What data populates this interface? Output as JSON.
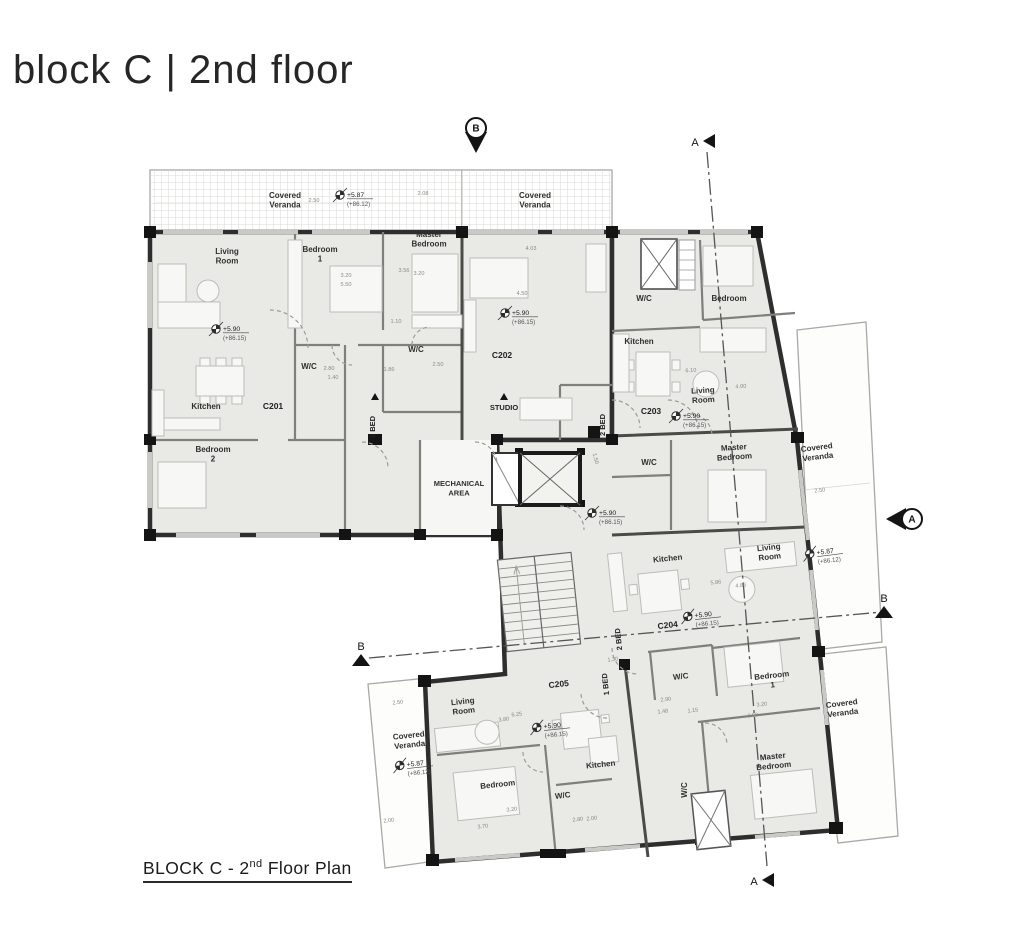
{
  "title": "block C | 2nd floor",
  "caption": {
    "prefix": "BLOCK C - 2",
    "sup": "nd",
    "suffix": " Floor Plan"
  },
  "sections": {
    "a": "A",
    "b": "B"
  },
  "labels": {
    "veranda": "Covered Veranda",
    "mechanical": "MECHANICAL AREA",
    "units": [
      "C201",
      "C202",
      "C203",
      "C204",
      "C205"
    ],
    "unit_types": [
      "3 BED",
      "STUDIO",
      "2 BED",
      "2 BED",
      "1 BED"
    ]
  },
  "rooms": [
    "Living Room",
    "Bedroom 1",
    "Master Bedroom",
    "W/C",
    "W/C",
    "Kitchen",
    "Bedroom 2",
    "W/C",
    "Kitchen",
    "Bedroom",
    "Living Room",
    "Master Bedroom",
    "W/C",
    "Kitchen",
    "Living Room",
    "W/C",
    "Bedroom 1",
    "Master Bedroom",
    "W/C",
    "Living Room",
    "Kitchen",
    "Bedroom",
    "W/C"
  ],
  "levels": [
    {
      "value": "+5.90",
      "datum": "(+86.15)"
    },
    {
      "value": "+5.90",
      "datum": "(+86.15)"
    },
    {
      "value": "+5.90",
      "datum": "(+86.15)"
    },
    {
      "value": "+5.90",
      "datum": "(+86.15)"
    },
    {
      "value": "+5.90",
      "datum": "(+86.15)"
    },
    {
      "value": "+5.90",
      "datum": "(+86.15)"
    },
    {
      "value": "+5.87",
      "datum": "(+86.12)"
    },
    {
      "value": "+5.87",
      "datum": "(+86.12)"
    },
    {
      "value": "+5.87",
      "datum": "(+86.12)"
    }
  ],
  "dimensions": [
    "2.50",
    "2.08",
    "3.20",
    "5.50",
    "3.56",
    "3.20",
    "1.10",
    "2.80",
    "1.40",
    "1.86",
    "2.50",
    "4.03",
    "4.50",
    "6.10",
    "4.00",
    "1.50",
    "5.86",
    "4.86",
    "2.50",
    "1.30",
    "2.90",
    "1.48",
    "1.15",
    "3.20",
    "3.50",
    "6.25",
    "3.80",
    "3.20",
    "3.70",
    "2.80",
    "2.00",
    "2.50",
    "2.00"
  ],
  "colors": {
    "wall": "#2e2e2e",
    "partition": "#7f7f7b",
    "floor": "#e9e9e6",
    "accent": "#141414"
  }
}
